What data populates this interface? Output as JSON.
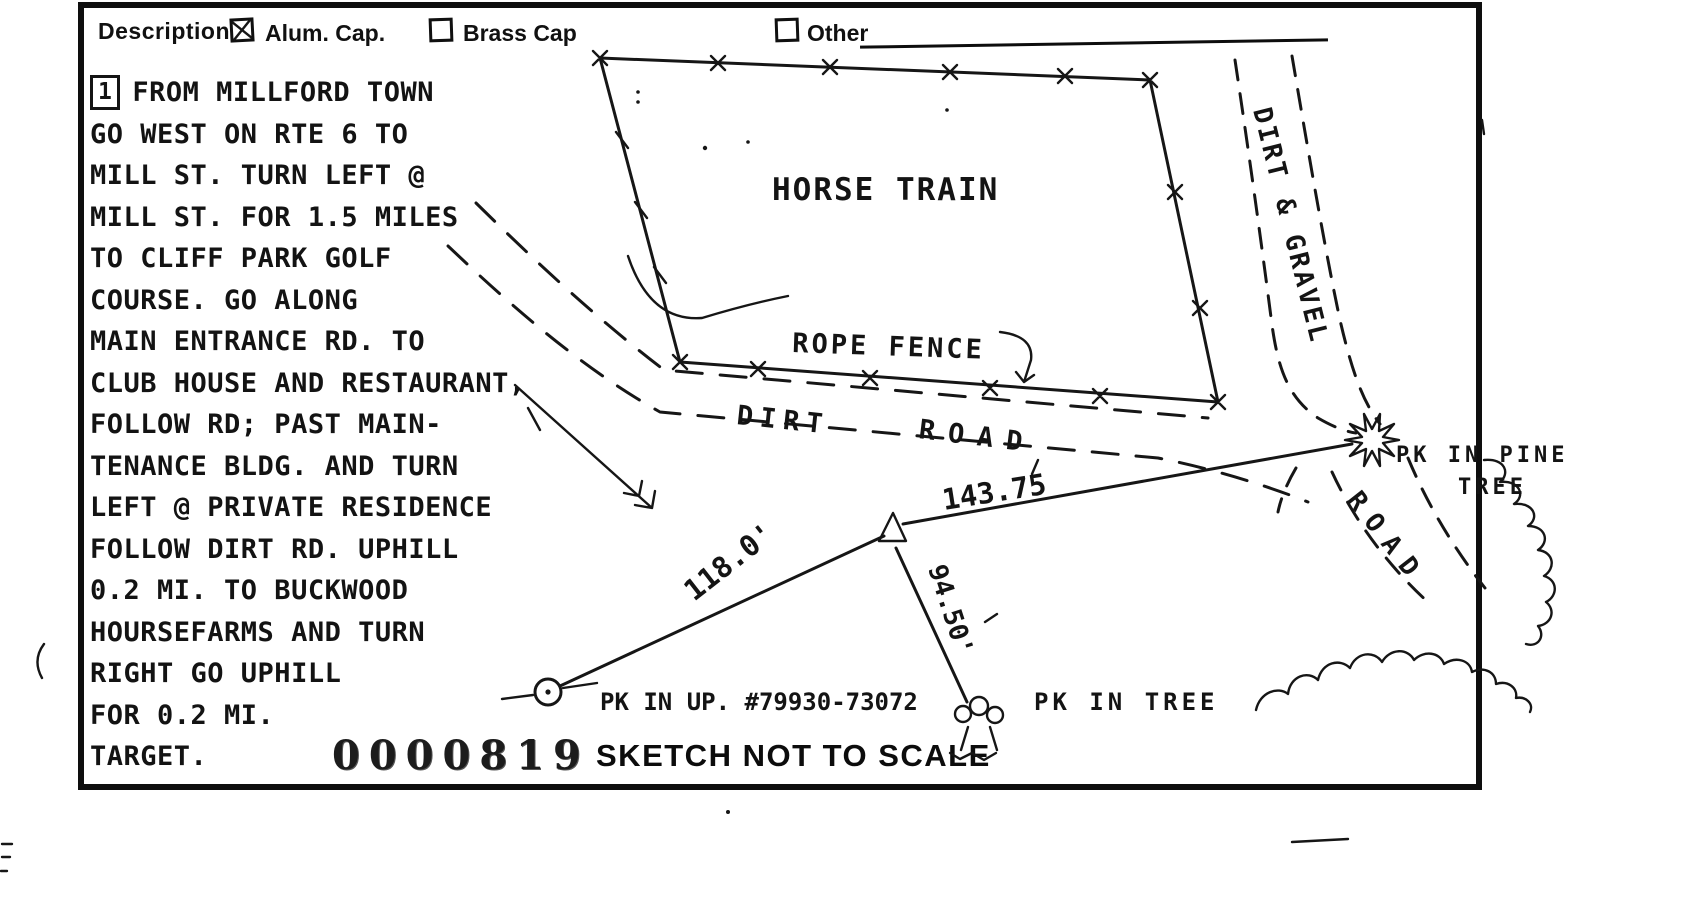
{
  "header": {
    "description_label": "Description:",
    "checkboxes": [
      {
        "label": "Alum. Cap.",
        "checked": true
      },
      {
        "label": "Brass Cap",
        "checked": false
      },
      {
        "label": "Other",
        "checked": false
      }
    ]
  },
  "directions": {
    "marker": "1",
    "lines": [
      "FROM MILLFORD TOWN",
      "GO WEST ON RTE 6 TO",
      "MILL ST. TURN LEFT @",
      "MILL ST. FOR 1.5 MILES",
      "TO CLIFF PARK GOLF",
      "COURSE. GO ALONG",
      "MAIN ENTRANCE RD. TO",
      "CLUB HOUSE AND RESTAURANT,",
      "FOLLOW RD; PAST MAIN-",
      "TENANCE BLDG. AND TURN",
      "LEFT @ PRIVATE RESIDENCE",
      "FOLLOW DIRT RD. UPHILL",
      "0.2 MI. TO BUCKWOOD",
      "HOURSEFARMS AND TURN",
      "RIGHT GO UPHILL",
      "FOR 0.2 MI.",
      "TARGET."
    ]
  },
  "stamp": {
    "number": "0000819"
  },
  "sketch": {
    "labels": {
      "paddock": "HORSE TRAIN",
      "rope_fence": "ROPE FENCE",
      "dirt": "DIRT",
      "road": "ROAD",
      "dirt_gravel_road": "DIRT & GRAVEL",
      "side_road": "ROAD",
      "pk_pine_1": "PK IN PINE",
      "pk_pine_2": "TREE",
      "pk_up": "PK IN UP. #79930-73072",
      "pk_tree": "PK IN TREE",
      "dist_triangle_pine": "143.75",
      "dist_up_triangle": "118.0'",
      "dist_triangle_tree": "94.50'"
    }
  },
  "footer": {
    "note": "SKETCH NOT TO SCALE"
  },
  "colors": {
    "ink": "#161616",
    "paper": "#ffffff"
  }
}
